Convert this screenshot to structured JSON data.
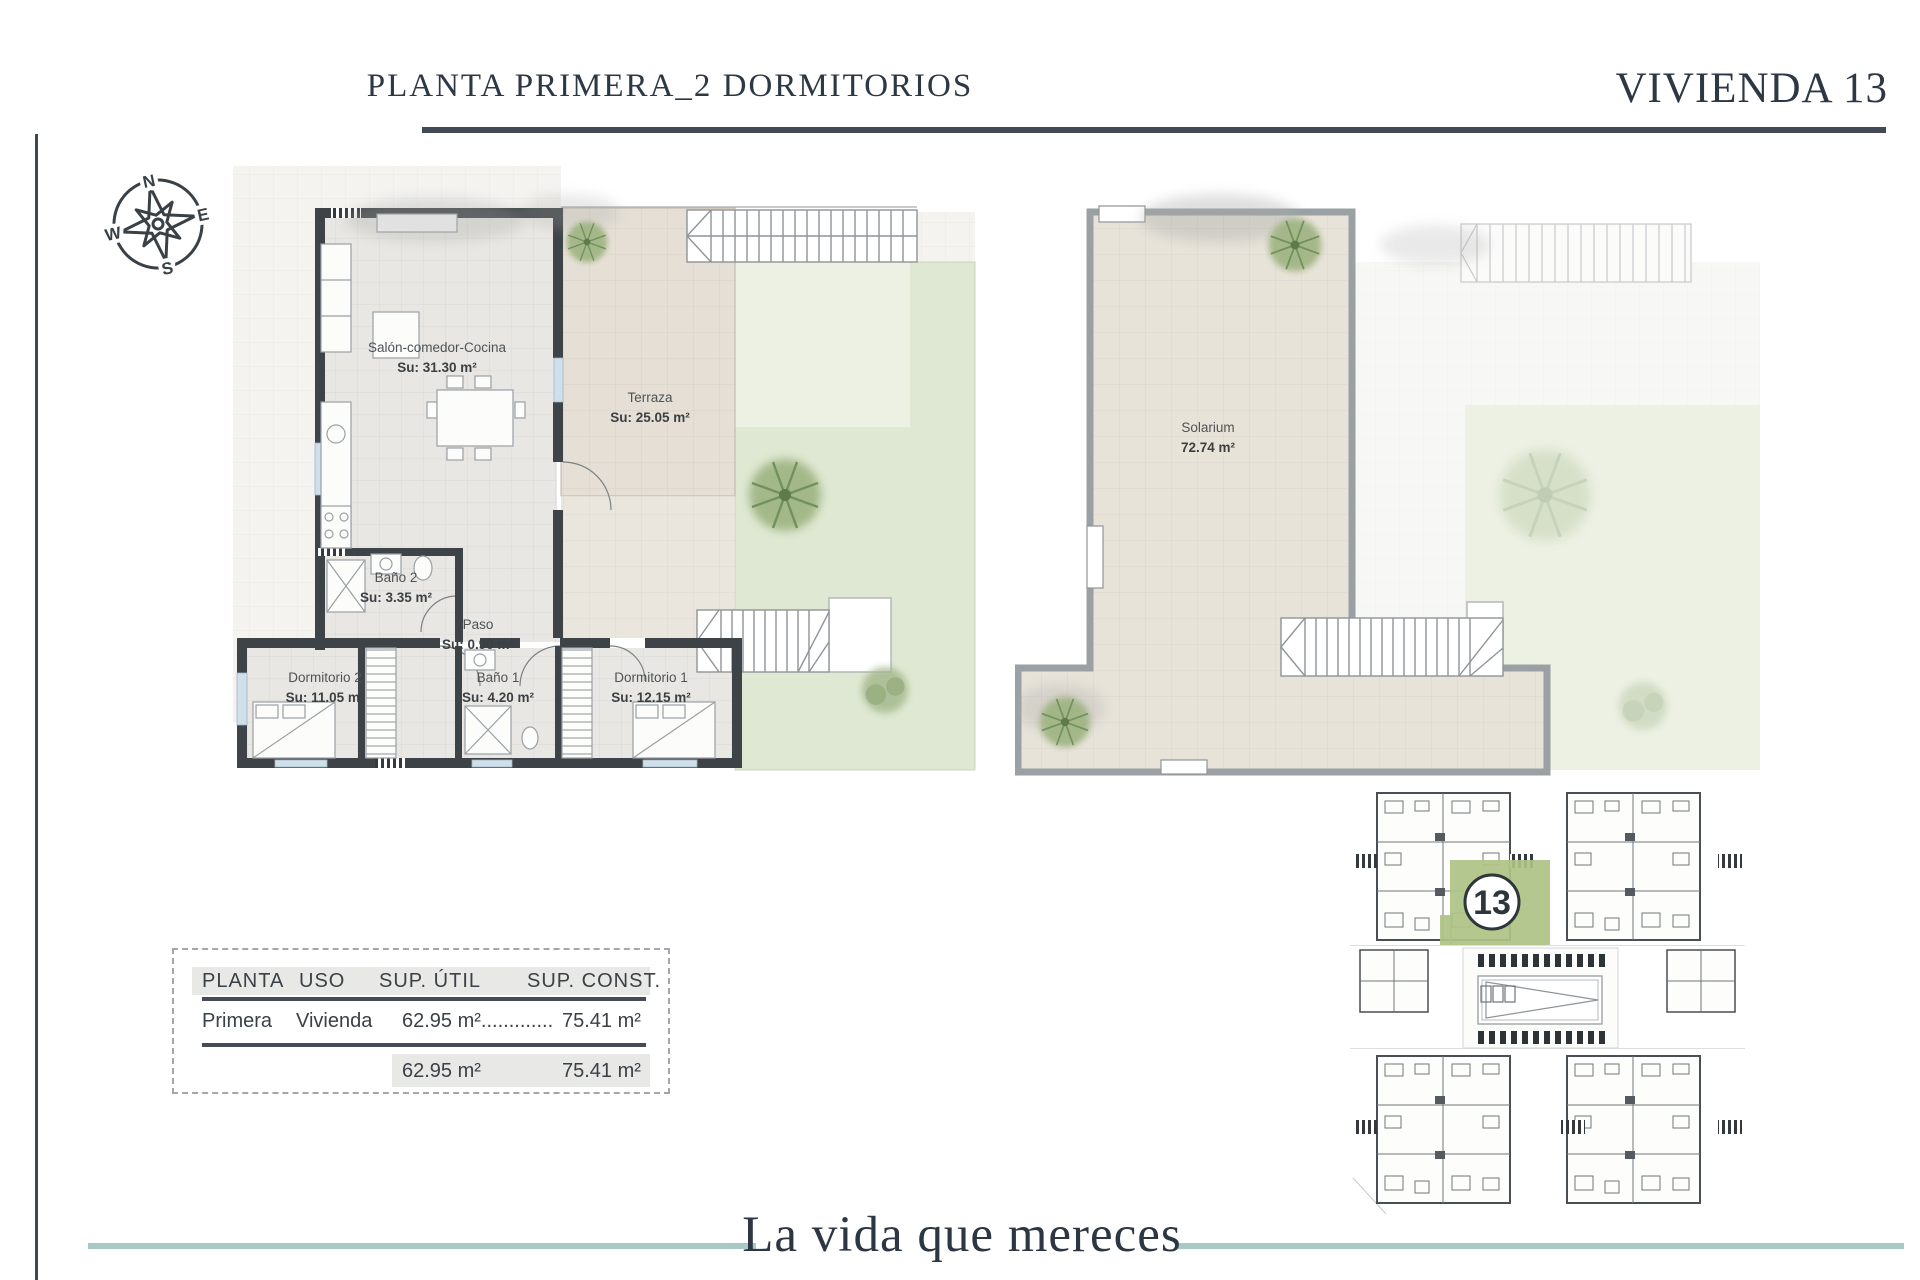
{
  "header": {
    "title": "PLANTA PRIMERA_2 DORMITORIOS",
    "unit_label": "VIVIENDA 13"
  },
  "compass": {
    "north": "N",
    "east": "E",
    "south": "S",
    "west": "W"
  },
  "first_floor_plan": {
    "rooms": [
      {
        "name": "Salón-comedor-Cocina",
        "area": "Su: 31.30 m²"
      },
      {
        "name": "Terraza",
        "area": "Su: 25.05 m²"
      },
      {
        "name": "Baño 2",
        "area": "Su: 3.35 m²"
      },
      {
        "name": "Paso",
        "area": "Su: 0.90 m²"
      },
      {
        "name": "Dormitorio 2",
        "area": "Su: 11.05 m²"
      },
      {
        "name": "Baño 1",
        "area": "Su: 4.20 m²"
      },
      {
        "name": "Dormitorio 1",
        "area": "Su: 12.15 m²"
      }
    ]
  },
  "solarium_plan": {
    "name": "Solarium",
    "area": "72.74 m²"
  },
  "areas_table": {
    "headers": [
      "PLANTA",
      "USO",
      "SUP. ÚTIL",
      "SUP. CONST."
    ],
    "row": {
      "planta": "Primera",
      "uso": "Vivienda",
      "sup_util": "62.95 m².............",
      "sup_const": "75.41 m²"
    },
    "totals": {
      "sup_util": "62.95 m²",
      "sup_const": "75.41 m²"
    }
  },
  "site_plan": {
    "highlighted_unit": "13"
  },
  "footer": {
    "tagline": "La vida que mereces"
  },
  "colors": {
    "ink": "#2d3845",
    "teal_line": "#a8cac6",
    "wall": "#3e4347",
    "terrace_tile": "#e5dfd5",
    "interior_tile": "#e9e7e3",
    "garden": "#dee8d2",
    "unit_highlight": "#aec284",
    "table_header_bg": "#e8e8e6"
  }
}
